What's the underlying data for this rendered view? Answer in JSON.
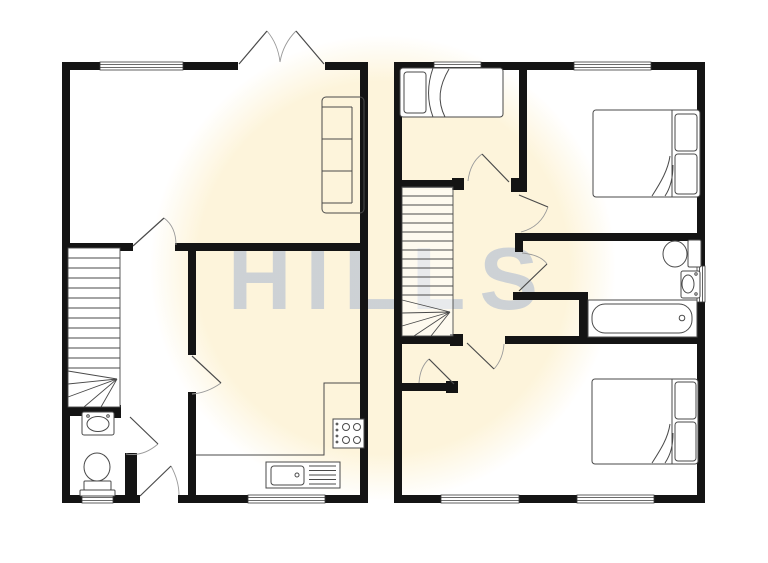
{
  "watermark": {
    "text": "HILLS"
  },
  "colors": {
    "background": "#ffffff",
    "wall": "#141414",
    "line": "#4a4a4a",
    "arc": "#9a9a9a",
    "circle": "#fdf4da",
    "watermark": "#9fb0d0"
  },
  "plan": {
    "ground_floor_fixtures": [
      "sofa",
      "french-doors",
      "staircase",
      "basin",
      "toilet",
      "kitchen-counter",
      "hob",
      "sink",
      "front-door"
    ],
    "first_floor_fixtures": [
      "single-bed",
      "double-bed",
      "double-bed",
      "staircase",
      "landing-cupboard",
      "toilet",
      "basin",
      "bath"
    ]
  }
}
